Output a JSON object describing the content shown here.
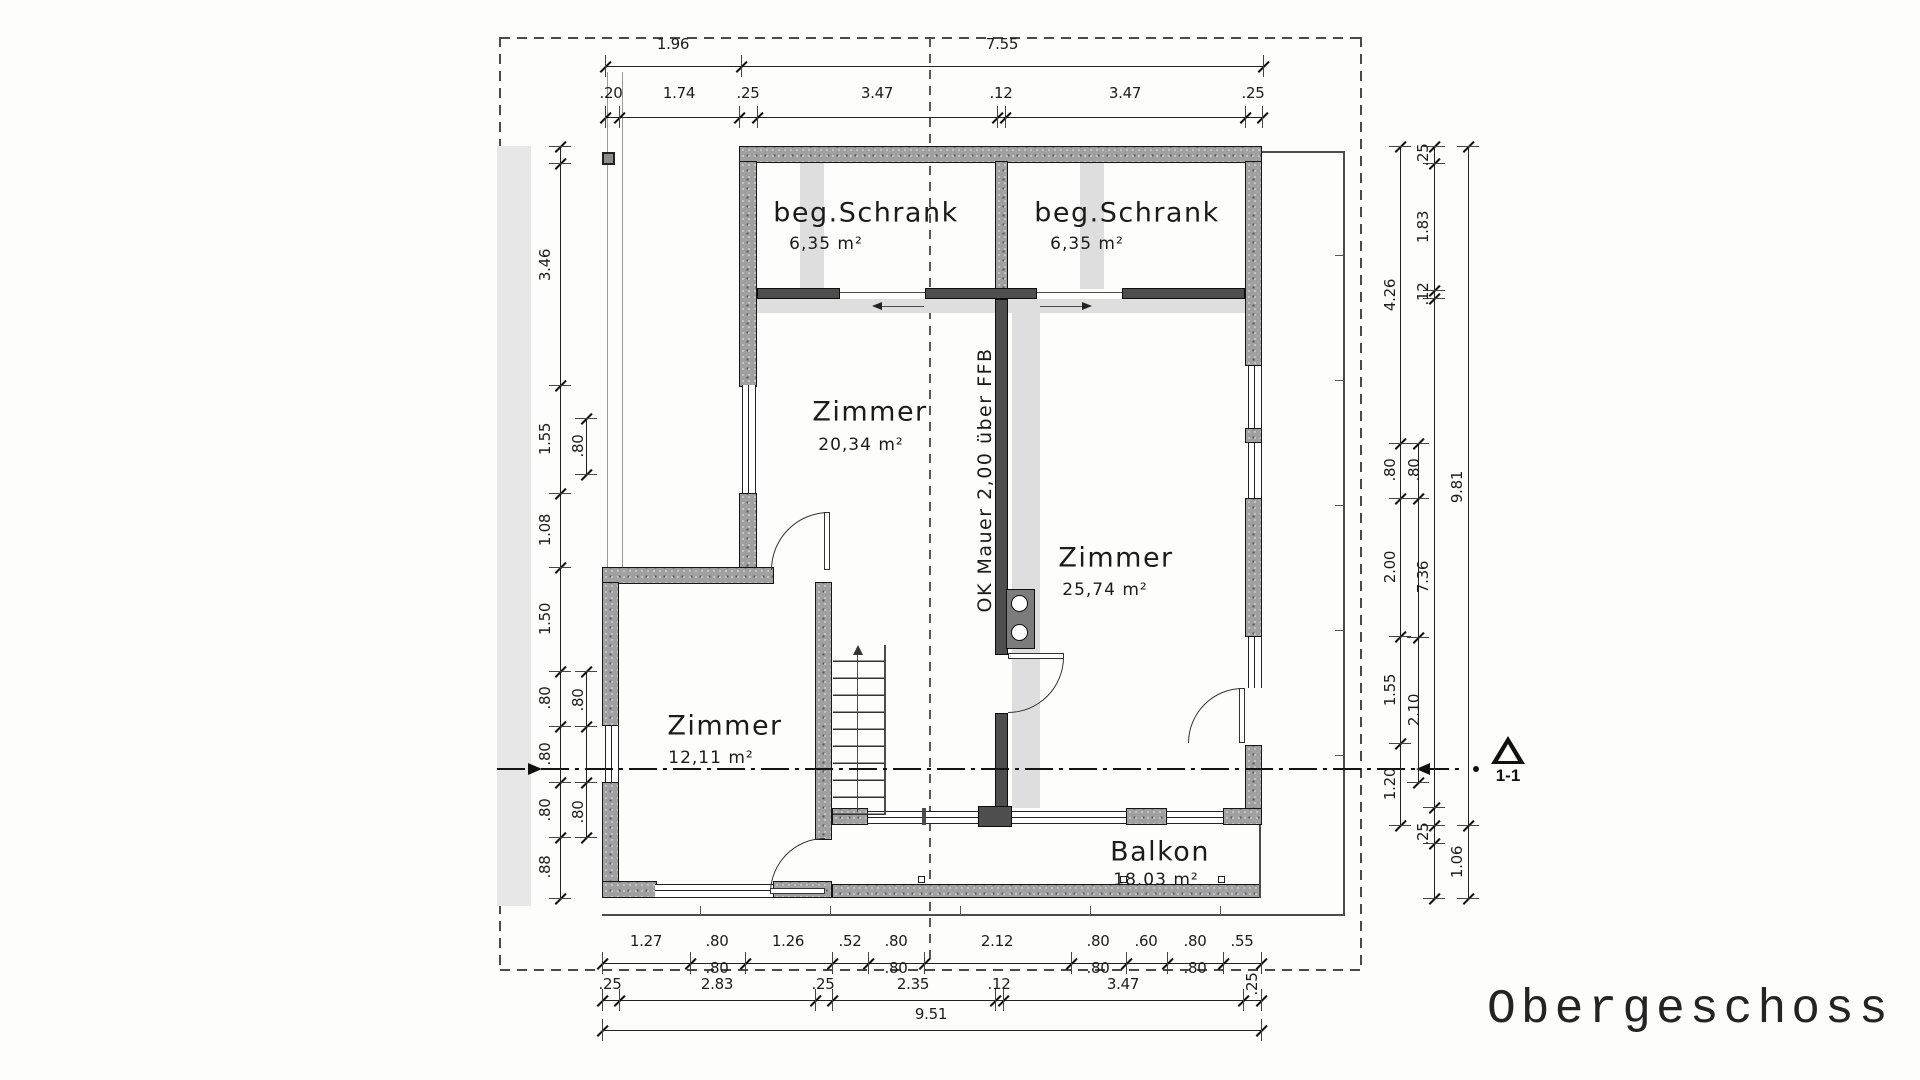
{
  "title": "Obergeschoss",
  "section_label": "1-1",
  "wall_note": "OK Mauer 2,00 über FFB",
  "rooms": [
    {
      "id": "schrank-left",
      "name": "beg.Schrank",
      "area": "6,35 m²",
      "cx": 866,
      "cy": 213,
      "ax": 826,
      "ay": 244
    },
    {
      "id": "schrank-right",
      "name": "beg.Schrank",
      "area": "6,35 m²",
      "cx": 1127,
      "cy": 213,
      "ax": 1087,
      "ay": 244
    },
    {
      "id": "zimmer-20",
      "name": "Zimmer",
      "area": "20,34 m²",
      "cx": 870,
      "cy": 412,
      "ax": 861,
      "ay": 445
    },
    {
      "id": "zimmer-25",
      "name": "Zimmer",
      "area": "25,74 m²",
      "cx": 1116,
      "cy": 558,
      "ax": 1105,
      "ay": 590
    },
    {
      "id": "zimmer-12",
      "name": "Zimmer",
      "area": "12,11 m²",
      "cx": 725,
      "cy": 726,
      "ax": 711,
      "ay": 758
    },
    {
      "id": "balkon",
      "name": "Balkon",
      "area": "18.03 m²",
      "cx": 1160,
      "cy": 852,
      "ax": 1156,
      "ay": 880
    }
  ],
  "dims": {
    "h": [
      {
        "y": 66,
        "x1": 605,
        "x2": 1263,
        "ticks": [
          605,
          741,
          1263
        ],
        "ly": 44,
        "labels": [
          {
            "t": "1.96",
            "x": 673
          },
          {
            "t": "7.55",
            "x": 1002
          }
        ]
      },
      {
        "y": 117,
        "x1": 605,
        "x2": 1262,
        "ticks": [
          605,
          619,
          739,
          757,
          997,
          1005,
          1245,
          1262
        ],
        "ly": 93,
        "labels": [
          {
            "t": ".20",
            "x": 611
          },
          {
            "t": "1.74",
            "x": 679
          },
          {
            "t": ".25",
            "x": 748
          },
          {
            "t": "3.47",
            "x": 877
          },
          {
            "t": ".12",
            "x": 1001
          },
          {
            "t": "3.47",
            "x": 1125
          },
          {
            "t": ".25",
            "x": 1253
          }
        ]
      },
      {
        "y": 963,
        "x1": 602,
        "x2": 1261,
        "ticks": [
          602,
          690,
          745,
          832,
          868,
          924,
          1071,
          1126,
          1167,
          1223,
          1261
        ],
        "ly": 941,
        "labels": [
          {
            "t": "1.27",
            "x": 646
          },
          {
            "t": ".80",
            "x": 717
          },
          {
            "t": "1.26",
            "x": 788
          },
          {
            "t": ".52",
            "x": 850
          },
          {
            "t": ".80",
            "x": 896
          },
          {
            "t": "2.12",
            "x": 997
          },
          {
            "t": ".80",
            "x": 1098
          },
          {
            "t": ".60",
            "x": 1146
          },
          {
            "t": ".80",
            "x": 1195
          },
          {
            "t": ".55",
            "x": 1242
          }
        ]
      },
      {
        "y": null,
        "x1": null,
        "x2": null,
        "ticks": [],
        "ly": 968,
        "labels": [
          {
            "t": ".80",
            "x": 717
          },
          {
            "t": ".80",
            "x": 896
          },
          {
            "t": ".80",
            "x": 1098
          },
          {
            "t": ".80",
            "x": 1195
          }
        ]
      },
      {
        "y": 1000,
        "x1": 602,
        "x2": 1261,
        "ticks": [
          602,
          619,
          815,
          832,
          995,
          1003,
          1243,
          1261
        ],
        "ly": 984,
        "labels": [
          {
            "t": ".25",
            "x": 610
          },
          {
            "t": "2.83",
            "x": 717
          },
          {
            "t": ".25",
            "x": 823
          },
          {
            "t": "2.35",
            "x": 913
          },
          {
            "t": ".12",
            "x": 999
          },
          {
            "t": "3.47",
            "x": 1123
          },
          {
            "t": ".25",
            "x": 1252,
            "rot": true
          }
        ]
      },
      {
        "y": 1030,
        "x1": 602,
        "x2": 1261,
        "ticks": [
          602,
          1261
        ],
        "ly": 1014,
        "labels": [
          {
            "t": "9.51",
            "x": 931
          }
        ]
      }
    ],
    "v": [
      {
        "x": 560,
        "y1": 146,
        "y2": 898,
        "ticks": [
          146,
          163,
          385,
          493,
          567,
          671,
          726,
          782,
          837,
          898
        ],
        "lx": 545,
        "labels": [
          {
            "t": "3.46",
            "y": 265
          },
          {
            "t": "1.55",
            "y": 439
          },
          {
            "t": "1.08",
            "y": 530
          },
          {
            "t": "1.50",
            "y": 619
          },
          {
            "t": ".80",
            "y": 698
          },
          {
            "t": ".80",
            "y": 754
          },
          {
            "t": ".80",
            "y": 810
          },
          {
            "t": ".88",
            "y": 867
          }
        ]
      },
      {
        "x": 586,
        "y1": 418,
        "y2": 474,
        "ticks": [
          418,
          474
        ],
        "lx": 578,
        "labels": [
          {
            "t": ".80",
            "y": 446
          }
        ]
      },
      {
        "x": 586,
        "y1": 671,
        "y2": 837,
        "ticks": [
          671,
          726,
          782,
          837
        ],
        "lx": 578,
        "labels": [
          {
            "t": ".80",
            "y": 700
          },
          {
            "t": ".80",
            "y": 812
          }
        ]
      },
      {
        "x": 1400,
        "y1": 146,
        "y2": 825,
        "ticks": [
          146,
          443,
          498,
          636,
          743,
          825
        ],
        "lx": 1390,
        "labels": [
          {
            "t": "4.26",
            "y": 295
          },
          {
            "t": ".80",
            "y": 470
          },
          {
            "t": "2.00",
            "y": 567
          },
          {
            "t": "1.55",
            "y": 690
          },
          {
            "t": "1.20",
            "y": 784
          }
        ]
      },
      {
        "x": 1418,
        "y1": 443,
        "y2": 782,
        "ticks": [
          443,
          498,
          637,
          782
        ],
        "lx": 1414,
        "labels": [
          {
            "t": ".80",
            "y": 470
          },
          {
            "t": "2.10",
            "y": 710
          }
        ]
      },
      {
        "x": 1434,
        "y1": 146,
        "y2": 898,
        "ticks": [
          146,
          163,
          290,
          298,
          807,
          825,
          843,
          898
        ],
        "lx": 1423,
        "labels": [
          {
            "t": ".25",
            "y": 155
          },
          {
            "t": "1.83",
            "y": 227
          },
          {
            "t": ".12",
            "y": 294
          },
          {
            "t": "7.36",
            "y": 577
          },
          {
            "t": ".25",
            "y": 834
          }
        ]
      },
      {
        "x": 1468,
        "y1": 146,
        "y2": 898,
        "ticks": [
          146,
          825,
          898
        ],
        "lx": 1457,
        "labels": [
          {
            "t": "9.81",
            "y": 487
          },
          {
            "t": "1.06",
            "y": 862
          }
        ]
      }
    ]
  }
}
